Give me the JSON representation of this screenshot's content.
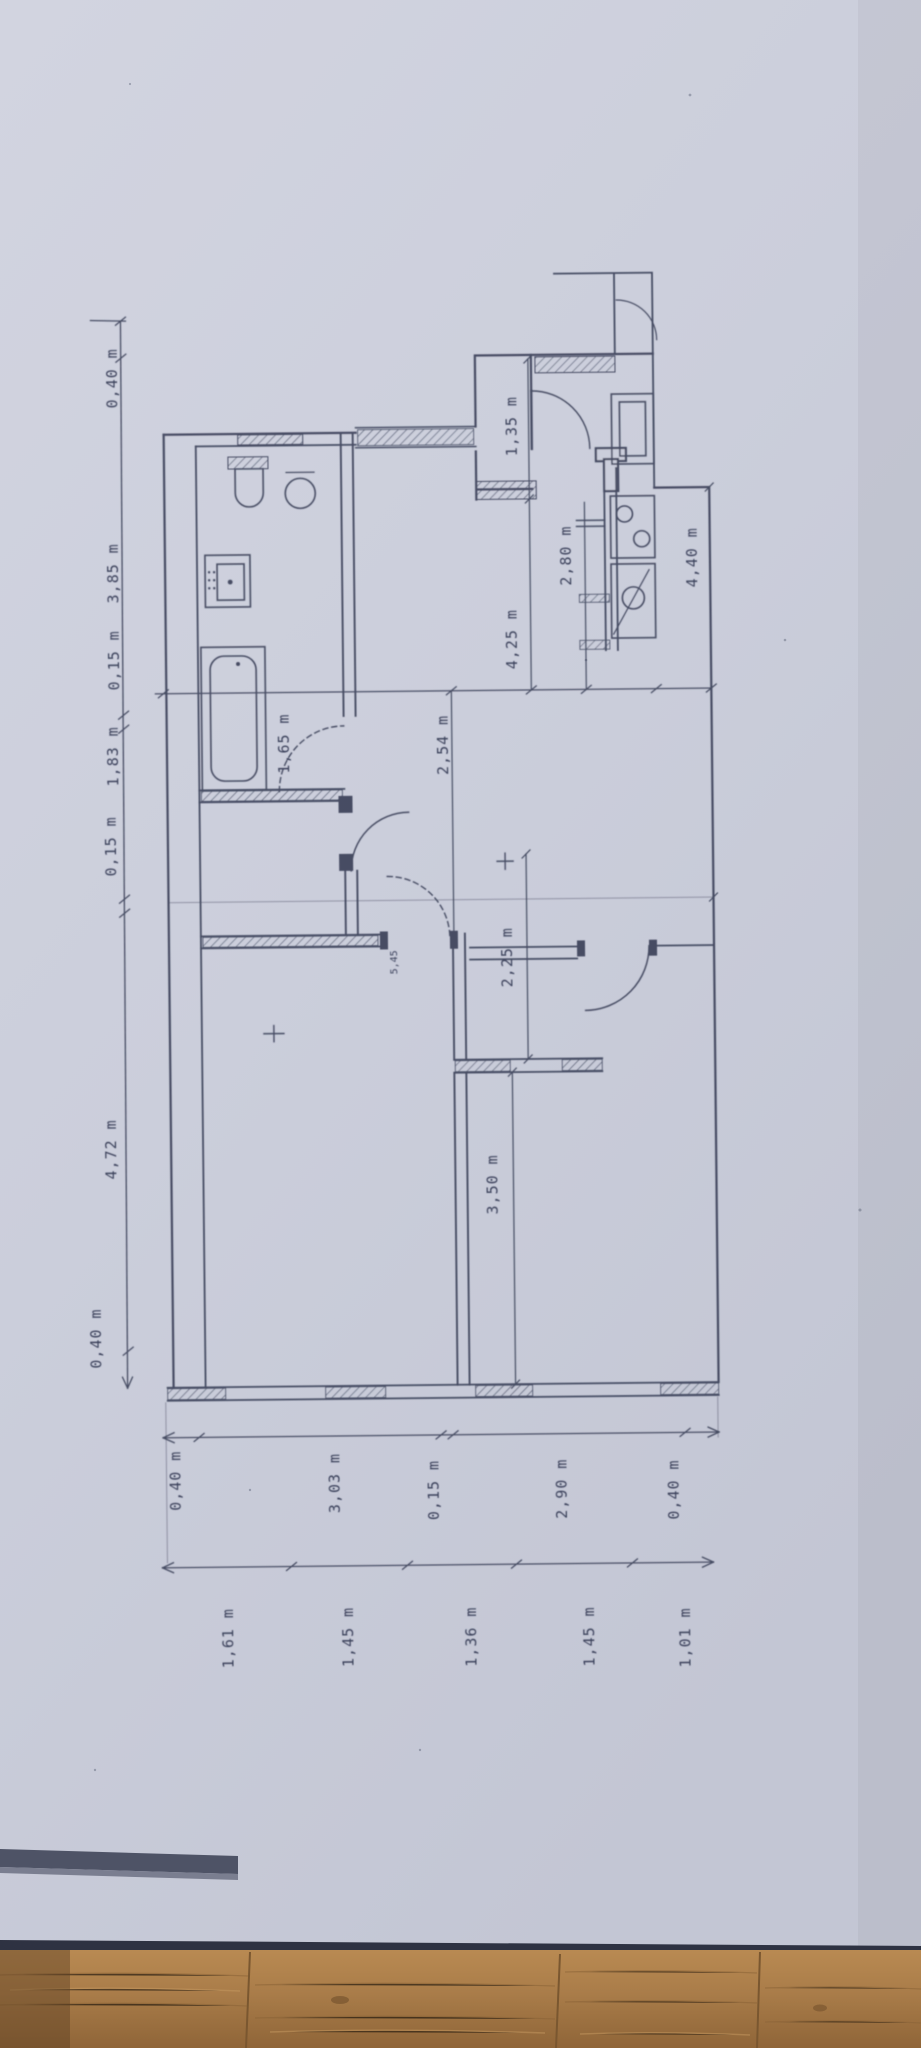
{
  "plan": {
    "top_chain": [
      "0,40 m",
      "3,85 m",
      "0,15 m",
      "1,83 m",
      "0,15 m",
      "4,72 m",
      "0,40 m"
    ],
    "bottom_inner_chain": [
      "0,40 m",
      "3,03 m",
      "0,15 m",
      "2,90 m",
      "0,40 m"
    ],
    "bottom_outer_chain": [
      "1,61 m",
      "1,45 m",
      "1,36 m",
      "1,45 m",
      "1,01 m"
    ],
    "interior_labels": [
      "1,35 m",
      "4,25 m",
      "2,54 m",
      "1,65 m",
      "2,80 m",
      "4,40 m",
      "2,25 m",
      "5,45",
      "3,50 m"
    ]
  },
  "colors": {
    "paper": "#cbcedb",
    "ink": "#3a4158",
    "text_ink": "#2e3450",
    "wood": "#a97c49",
    "shadow_band": "#4e5366",
    "paper_edge": "#2e3242"
  }
}
